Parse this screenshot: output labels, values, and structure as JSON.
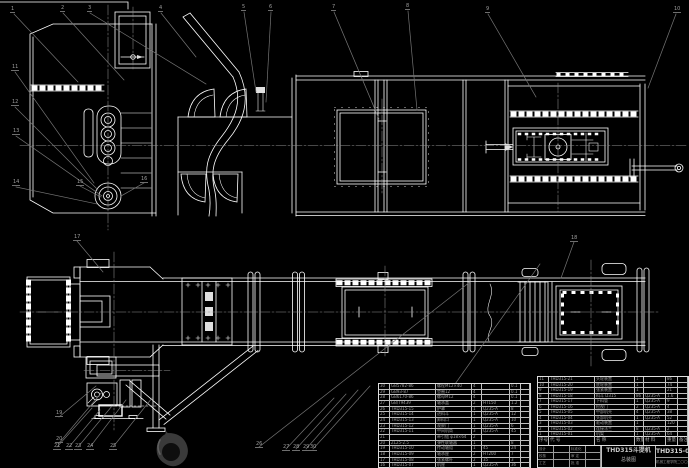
{
  "colors": {
    "background": "#000000",
    "line": "#ffffff",
    "leader": "#757575",
    "text_gray": "#9f9f9f"
  },
  "title_block": {
    "title": "THD315斗提机",
    "subtitle": "总装图",
    "drawing_no": "THD315-00",
    "org": "机械工程学院二〇〇六",
    "sig_rows": [
      {
        "a": "设计",
        "b": "",
        "c": "标准化",
        "d": ""
      },
      {
        "a": "校核",
        "b": "",
        "c": "审 定",
        "d": ""
      },
      {
        "a": "工艺",
        "b": "",
        "c": "批 准",
        "d": ""
      }
    ]
  },
  "parts_table_header": {
    "c0": "序号",
    "c1": "代 号",
    "c2": "名  称",
    "c3": "数量",
    "c4": "材 料",
    "c5": "重量",
    "c6": "备注"
  },
  "parts_table_left": {
    "rows": [
      {
        "c0": "30",
        "c1": "GB5782-86",
        "c2": "螺栓M12×40",
        "c3": "4",
        "c4": "",
        "c5": "0.1",
        "c6": ""
      },
      {
        "c0": "29",
        "c1": "GB93-87",
        "c2": "垫圈12",
        "c3": "4",
        "c4": "",
        "c5": "0.1",
        "c6": ""
      },
      {
        "c0": "28",
        "c1": "GB6170-86",
        "c2": "螺母M12",
        "c3": "4",
        "c4": "",
        "c5": "0.1",
        "c6": ""
      },
      {
        "c0": "27",
        "c1": "GB/T9439",
        "c2": "轴承盖",
        "c3": "2",
        "c4": "HT150",
        "c5": "1.2",
        "c6": ""
      },
      {
        "c0": "26",
        "c1": "THD315-15",
        "c2": "护罩",
        "c3": "1",
        "c4": "Q235-A",
        "c5": "8",
        "c6": ""
      },
      {
        "c0": "25",
        "c1": "THD315-14",
        "c2": "进料斗",
        "c3": "1",
        "c4": "Q235-A",
        "c5": "12",
        "c6": ""
      },
      {
        "c0": "24",
        "c1": "THD315-13",
        "c2": "卸料口",
        "c3": "1",
        "c4": "Q235-A",
        "c5": "10",
        "c6": ""
      },
      {
        "c0": "23",
        "c1": "THD315-12",
        "c2": "观察门",
        "c3": "1",
        "c4": "Q235-A",
        "c5": "6",
        "c6": ""
      },
      {
        "c0": "22",
        "c1": "THD315-11",
        "c2": "中间机筒",
        "c3": "3",
        "c4": "Q235-A",
        "c5": "45",
        "c6": ""
      },
      {
        "c0": "21",
        "c1": "",
        "c2": "牵引链 φ18×64",
        "c3": "2",
        "c4": "",
        "c5": "",
        "c6": ""
      },
      {
        "c0": "20",
        "c1": "ZL25-2.5",
        "c2": "弹性联轴器",
        "c3": "1",
        "c4": "",
        "c5": "8",
        "c6": ""
      },
      {
        "c0": "19",
        "c1": "THD315-10",
        "c2": "传动轴组",
        "c3": "1",
        "c4": "45",
        "c5": "24",
        "c6": ""
      },
      {
        "c0": "18",
        "c1": "THD315-09",
        "c2": "轴承座",
        "c3": "2",
        "c4": "HT200",
        "c5": "7",
        "c6": ""
      },
      {
        "c0": "17",
        "c1": "THD315-08",
        "c2": "张紧螺杆",
        "c3": "2",
        "c4": "35",
        "c5": "3",
        "c6": ""
      },
      {
        "c0": "16",
        "c1": "THD315-07",
        "c2": "机座",
        "c3": "1",
        "c4": "Q235-A",
        "c5": "36",
        "c6": ""
      }
    ]
  },
  "parts_table_right": {
    "rows": [
      {
        "c0": "11",
        "c1": "THD315-21",
        "c2": "头轮装置",
        "c3": "1",
        "c4": "",
        "c5": "86",
        "c6": ""
      },
      {
        "c0": "10",
        "c1": "THD315-20",
        "c2": "底轮装置",
        "c3": "1",
        "c4": "",
        "c5": "74",
        "c6": ""
      },
      {
        "c0": "9",
        "c1": "THD315-19",
        "c2": "张紧装置",
        "c3": "1",
        "c4": "",
        "c5": "21",
        "c6": ""
      },
      {
        "c0": "8",
        "c1": "THD315-18",
        "c2": "料斗 D315",
        "c3": "86",
        "c4": "Q235-A",
        "c5": "1.6",
        "c6": ""
      },
      {
        "c0": "7",
        "c1": "THD315-17",
        "c2": "下料管",
        "c3": "1",
        "c4": "Q235-A",
        "c5": "9",
        "c6": ""
      },
      {
        "c0": "6",
        "c1": "THD315-16",
        "c2": "检视门",
        "c3": "2",
        "c4": "Q235-A",
        "c5": "4",
        "c6": ""
      },
      {
        "c0": "5",
        "c1": "THD315-05",
        "c2": "中部机壳",
        "c3": "4",
        "c4": "Q235-A",
        "c5": "38",
        "c6": ""
      },
      {
        "c0": "4",
        "c1": "THD315-04",
        "c2": "头部机壳",
        "c3": "1",
        "c4": "Q235-A",
        "c5": "52",
        "c6": ""
      },
      {
        "c0": "3",
        "c1": "THD315-03",
        "c2": "驱动装置",
        "c3": "1",
        "c4": "",
        "c5": "120",
        "c6": ""
      },
      {
        "c0": "2",
        "c1": "THD315-02",
        "c2": "连接法兰",
        "c3": "8",
        "c4": "Q235-A",
        "c5": "2",
        "c6": ""
      },
      {
        "c0": "1",
        "c1": "THD315-01",
        "c2": "机架",
        "c3": "1",
        "c4": "Q235-A",
        "c5": "64",
        "c6": ""
      }
    ]
  },
  "balloons": [
    {
      "n": "1",
      "pos": "left:10px;top:7px"
    },
    {
      "n": "2",
      "pos": "left:60px;top:6px"
    },
    {
      "n": "3",
      "pos": "left:87px;top:6px"
    },
    {
      "n": "4",
      "pos": "left:158px;top:6px"
    },
    {
      "n": "5",
      "pos": "left:241px;top:5px"
    },
    {
      "n": "6",
      "pos": "left:268px;top:5px"
    },
    {
      "n": "7",
      "pos": "left:331px;top:5px"
    },
    {
      "n": "8",
      "pos": "left:405px;top:4px"
    },
    {
      "n": "9",
      "pos": "left:485px;top:7px"
    },
    {
      "n": "10",
      "pos": "left:673px;top:7px"
    },
    {
      "n": "11",
      "pos": "left:11px;top:65px"
    },
    {
      "n": "12",
      "pos": "left:11px;top:100px"
    },
    {
      "n": "13",
      "pos": "left:12px;top:129px"
    },
    {
      "n": "14",
      "pos": "left:12px;top:180px"
    },
    {
      "n": "15",
      "pos": "left:76px;top:180px"
    },
    {
      "n": "16",
      "pos": "left:140px;top:177px"
    },
    {
      "n": "17",
      "pos": "left:73px;top:235px"
    },
    {
      "n": "18",
      "pos": "left:570px;top:236px"
    },
    {
      "n": "19",
      "pos": "left:55px;top:411px"
    },
    {
      "n": "20",
      "pos": "left:55px;top:437px"
    },
    {
      "n": "21",
      "pos": "left:53px;top:444px"
    },
    {
      "n": "22",
      "pos": "left:65px;top:444px"
    },
    {
      "n": "23",
      "pos": "left:74px;top:444px"
    },
    {
      "n": "24",
      "pos": "left:86px;top:444px"
    },
    {
      "n": "25",
      "pos": "left:109px;top:444px"
    },
    {
      "n": "26",
      "pos": "left:255px;top:442px"
    },
    {
      "n": "27",
      "pos": "left:282px;top:445px"
    },
    {
      "n": "28",
      "pos": "left:292px;top:445px"
    },
    {
      "n": "29",
      "pos": "left:302px;top:445px"
    },
    {
      "n": "30",
      "pos": "left:309px;top:445px"
    }
  ]
}
